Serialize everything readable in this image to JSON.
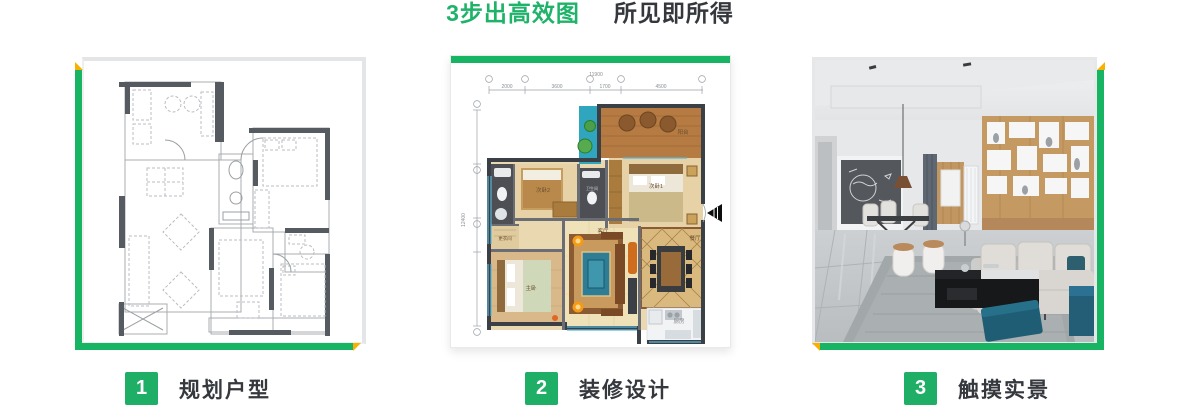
{
  "title": {
    "highlight": "3步出高效图",
    "rest": "所见即所得"
  },
  "steps": [
    {
      "number": "1",
      "label": "规划户型"
    },
    {
      "number": "2",
      "label": "装修设计"
    },
    {
      "number": "3",
      "label": "触摸实景"
    }
  ],
  "colors": {
    "accent_green": "#17b464",
    "corner_yellow": "#f9b000",
    "step_square_green": "#1fae66",
    "title_green": "#1fb269",
    "text_dark": "#34373c"
  },
  "floorplan": {
    "total_width_dim": "11900",
    "top_dims": [
      "2000",
      "3600",
      "1700",
      "4500"
    ],
    "left_total_dim": "12400",
    "rooms": [
      "阳台",
      "次卧1",
      "次卧2",
      "主卧",
      "客厅",
      "餐厅",
      "厨房",
      "更衣间",
      "卫生间"
    ]
  }
}
